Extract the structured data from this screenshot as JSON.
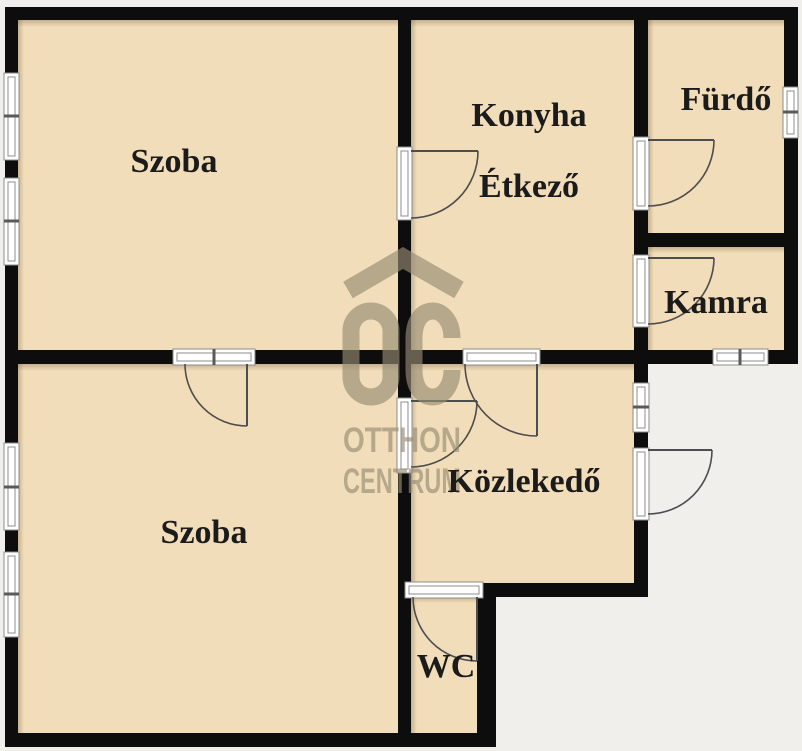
{
  "floorplan": {
    "rooms": [
      {
        "id": "szoba-top",
        "label": "Szoba"
      },
      {
        "id": "konyha",
        "label": "Konyha"
      },
      {
        "id": "etkezo",
        "label": "Étkező"
      },
      {
        "id": "furdo",
        "label": "Fürdő"
      },
      {
        "id": "kamra",
        "label": "Kamra"
      },
      {
        "id": "szoba-bottom",
        "label": "Szoba"
      },
      {
        "id": "kozlekedo",
        "label": "Közlekedő"
      },
      {
        "id": "wc",
        "label": "WC"
      }
    ],
    "watermark": {
      "line1": "OTTHON",
      "line2": "CENTRUM"
    },
    "colors": {
      "floor": "#f2ddba",
      "wall": "#0d0d0d",
      "exterior": "#f0efec",
      "watermark": "#968c73",
      "label_text": "#1b1b1b",
      "frame_outline": "#8c8c8c"
    }
  }
}
